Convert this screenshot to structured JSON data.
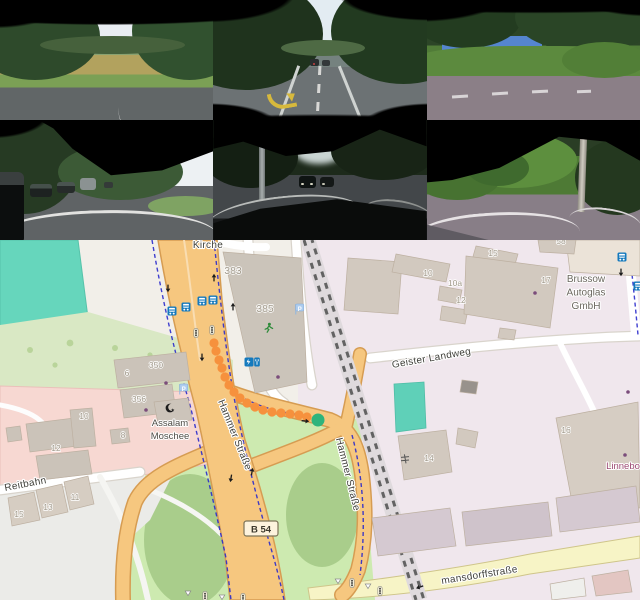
{
  "cameras": {
    "rows": 2,
    "cols": 3,
    "views": [
      "front-left",
      "front",
      "front-right",
      "back-left",
      "back",
      "back-right"
    ]
  },
  "map": {
    "colors": {
      "land": "#f2efe9",
      "industrial": "#f0e7ed",
      "retail": "#f7d8d2",
      "grass": "#cdeab0",
      "scrub": "#a9cd8b",
      "pitch": "#66d6bc",
      "parking": "#ebebe8",
      "primary_road": "#f6c77f",
      "primary_casing": "#d69c52",
      "secondary_road": "#f7f4c6",
      "minor_road": "#ffffff",
      "railway": "#636363",
      "cycle_route": "#2b2bcc",
      "building": "#d2c9bf",
      "route_dot": "#f6913d",
      "route_end": "#2eb47c",
      "bus_icon": "#1479bd"
    },
    "street_labels": [
      {
        "text": "Kirche",
        "x": 208,
        "y": 8,
        "rot": 0,
        "size": 10
      },
      {
        "text": "Hammer Straße",
        "x": 232,
        "y": 196,
        "rot": 68,
        "size": 10
      },
      {
        "text": "Hammer Straße",
        "x": 345,
        "y": 235,
        "rot": 76,
        "size": 10
      },
      {
        "text": "Geister Landweg",
        "x": 432,
        "y": 121,
        "rot": -10,
        "size": 10
      },
      {
        "text": "Reitbahn",
        "x": 26,
        "y": 247,
        "rot": -11,
        "size": 10
      },
      {
        "text": "mansdorffstraße",
        "x": 480,
        "y": 338,
        "rot": -9,
        "size": 10
      }
    ],
    "poi_labels": [
      {
        "lines": [
          "Assalam",
          "Moschee"
        ],
        "x": 170,
        "y": 186,
        "size": 9.5,
        "color": "#4e4c46"
      },
      {
        "lines": [
          "Brussow",
          "Autoglas",
          "GmbH"
        ],
        "x": 586,
        "y": 42,
        "size": 10,
        "color": "#6b675f"
      },
      {
        "lines": [
          "Linnebo"
        ],
        "x": 623,
        "y": 229,
        "size": 9.5,
        "color": "#9c4a73"
      }
    ],
    "house_numbers": [
      {
        "t": "383",
        "x": 233,
        "y": 34,
        "s": 10.5
      },
      {
        "t": "385",
        "x": 265,
        "y": 72,
        "s": 10.5
      },
      {
        "t": "350",
        "x": 156,
        "y": 128
      },
      {
        "t": "6",
        "x": 127,
        "y": 136
      },
      {
        "t": "356",
        "x": 139,
        "y": 162
      },
      {
        "t": "10",
        "x": 84,
        "y": 179
      },
      {
        "t": "8",
        "x": 123,
        "y": 198
      },
      {
        "t": "12",
        "x": 56,
        "y": 211
      },
      {
        "t": "11",
        "x": 75,
        "y": 260
      },
      {
        "t": "13",
        "x": 48,
        "y": 270
      },
      {
        "t": "15",
        "x": 19,
        "y": 277
      },
      {
        "t": "15",
        "x": 493,
        "y": 16
      },
      {
        "t": "10",
        "x": 428,
        "y": 36
      },
      {
        "t": "10a",
        "x": 455,
        "y": 46
      },
      {
        "t": "12",
        "x": 461,
        "y": 63
      },
      {
        "t": "17",
        "x": 546,
        "y": 43
      },
      {
        "t": "58",
        "x": 561,
        "y": 4
      },
      {
        "t": "16",
        "x": 566,
        "y": 193
      },
      {
        "t": "14",
        "x": 429,
        "y": 221
      }
    ],
    "route_ref_badge": {
      "text": "B 54",
      "x": 261,
      "y": 289
    },
    "route": {
      "dots": [
        [
          214,
          103
        ],
        [
          216,
          111
        ],
        [
          219,
          120
        ],
        [
          222,
          128
        ],
        [
          225,
          137
        ],
        [
          229,
          145
        ],
        [
          234,
          152
        ],
        [
          240,
          158
        ],
        [
          247,
          163
        ],
        [
          255,
          167
        ],
        [
          263,
          170
        ],
        [
          272,
          172
        ],
        [
          281,
          173
        ],
        [
          290,
          174
        ],
        [
          299,
          175
        ],
        [
          307,
          177
        ]
      ],
      "end": [
        318,
        180
      ]
    },
    "icons": [
      {
        "type": "bus-stop",
        "x": 172,
        "y": 71
      },
      {
        "type": "bus-stop",
        "x": 186,
        "y": 67
      },
      {
        "type": "bus-stop",
        "x": 202,
        "y": 61
      },
      {
        "type": "bus-stop",
        "x": 213,
        "y": 60
      },
      {
        "type": "bus-stop",
        "x": 622,
        "y": 17
      },
      {
        "type": "bus-stop",
        "x": 638,
        "y": 46
      },
      {
        "type": "traffic-signal",
        "x": 196,
        "y": 93
      },
      {
        "type": "traffic-signal",
        "x": 212,
        "y": 90
      },
      {
        "type": "traffic-signal",
        "x": 352,
        "y": 343
      },
      {
        "type": "traffic-signal",
        "x": 380,
        "y": 351
      },
      {
        "type": "traffic-signal",
        "x": 205,
        "y": 356
      },
      {
        "type": "traffic-signal",
        "x": 243,
        "y": 358
      },
      {
        "type": "parking",
        "x": 298,
        "y": 69
      },
      {
        "type": "parking",
        "x": 182,
        "y": 149
      },
      {
        "type": "charging-station",
        "x": 252,
        "y": 122
      },
      {
        "type": "runner",
        "x": 268,
        "y": 88
      },
      {
        "type": "mosque",
        "x": 170,
        "y": 168
      },
      {
        "type": "level-crossing",
        "x": 405,
        "y": 219
      },
      {
        "type": "give-way",
        "x": 338,
        "y": 341
      },
      {
        "type": "give-way",
        "x": 368,
        "y": 346
      },
      {
        "type": "give-way",
        "x": 188,
        "y": 353
      },
      {
        "type": "give-way",
        "x": 222,
        "y": 357
      },
      {
        "type": "oneway-arrow",
        "x": 168,
        "y": 48,
        "rot": 180
      },
      {
        "type": "oneway-arrow",
        "x": 214,
        "y": 38,
        "rot": 0
      },
      {
        "type": "oneway-arrow",
        "x": 233,
        "y": 67,
        "rot": 0
      },
      {
        "type": "oneway-arrow",
        "x": 202,
        "y": 117,
        "rot": 180
      },
      {
        "type": "oneway-arrow",
        "x": 305,
        "y": 181,
        "rot": 95
      },
      {
        "type": "oneway-arrow",
        "x": 621,
        "y": 32,
        "rot": 180
      },
      {
        "type": "oneway-arrow",
        "x": 420,
        "y": 347,
        "rot": 250
      },
      {
        "type": "oneway-arrow",
        "x": 252,
        "y": 232,
        "rot": 10
      },
      {
        "type": "oneway-arrow",
        "x": 231,
        "y": 238,
        "rot": 190
      }
    ]
  }
}
